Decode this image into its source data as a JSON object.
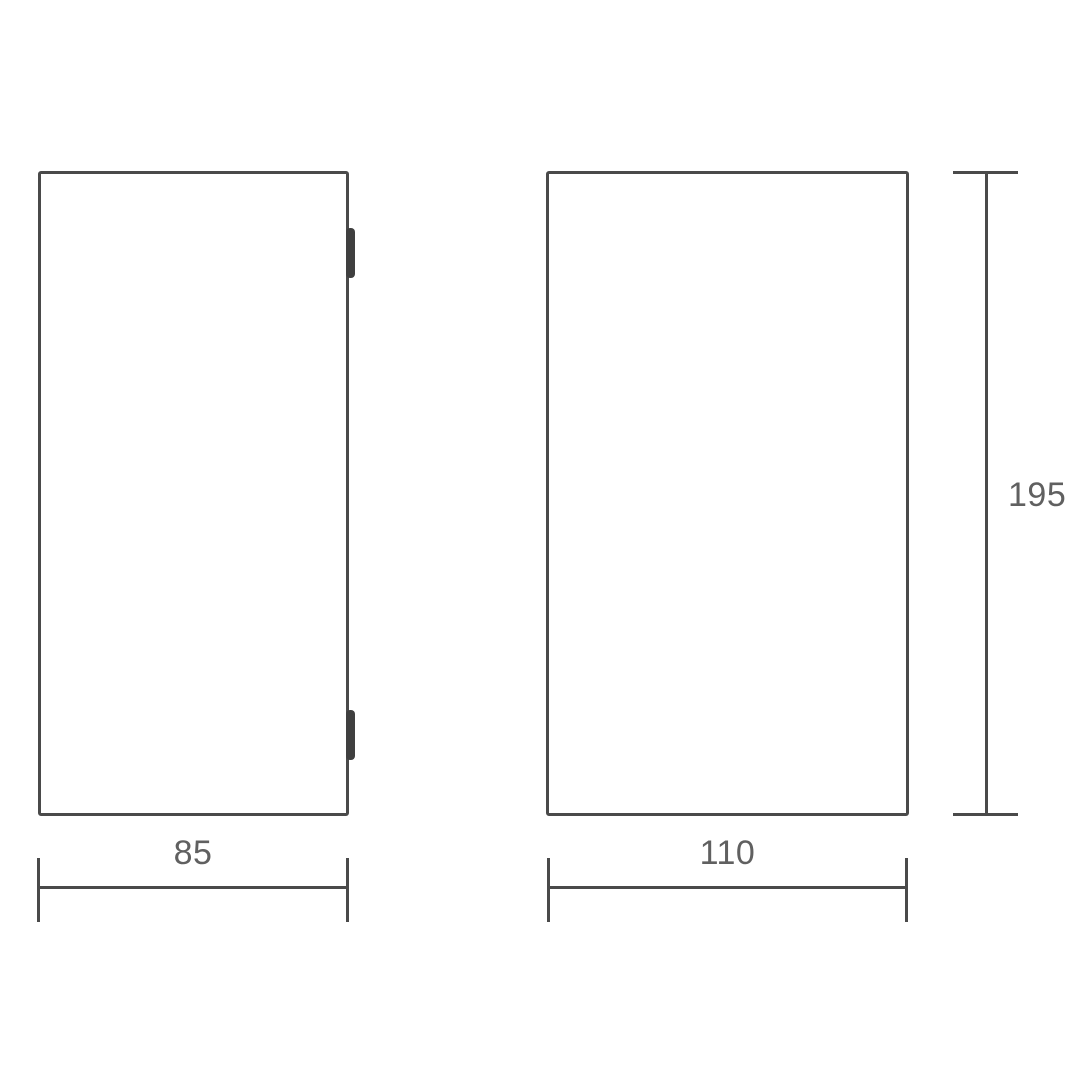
{
  "drawing": {
    "type": "technical-dimension-drawing",
    "views": {
      "side_view": {
        "description": "left rectangular outline with two mounting clips on right edge"
      },
      "front_view": {
        "description": "right rectangular outline"
      }
    },
    "dimensions": {
      "side_width": "85",
      "front_width": "110",
      "front_height": "195"
    },
    "colors": {
      "line": "#4a4a4a",
      "hinge": "#3f3f3f",
      "text": "#606060",
      "background": "#ffffff"
    }
  }
}
